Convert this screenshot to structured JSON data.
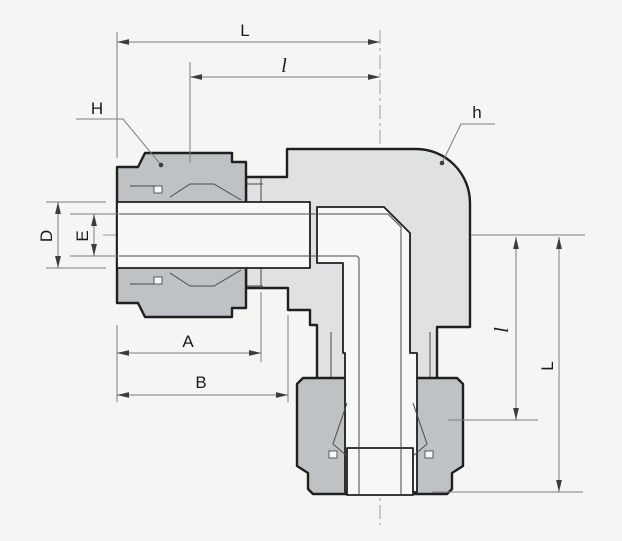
{
  "drawing": {
    "type": "engineering-cross-section-elbow-tube-fitting",
    "colors": {
      "bg": "#f5f5f4",
      "body-fill": "#dfe1e2",
      "nut-fill": "#bec2c5",
      "cavity-fill": "#f7f8f8",
      "outline": "#1f1f1f",
      "thin-line": "#4a4a4a",
      "dim-line": "#7d7d7d",
      "centerline": "#9a9a9a",
      "arrow": "#3c3c3c",
      "label": "#1a1a1a"
    },
    "labels": {
      "dim_L_top": "L",
      "dim_l_top": "l",
      "dim_H": "H",
      "dim_h": "h",
      "dim_D": "D",
      "dim_E": "E",
      "dim_A": "A",
      "dim_B": "B",
      "dim_l_right": "l",
      "dim_L_right": "L"
    }
  }
}
